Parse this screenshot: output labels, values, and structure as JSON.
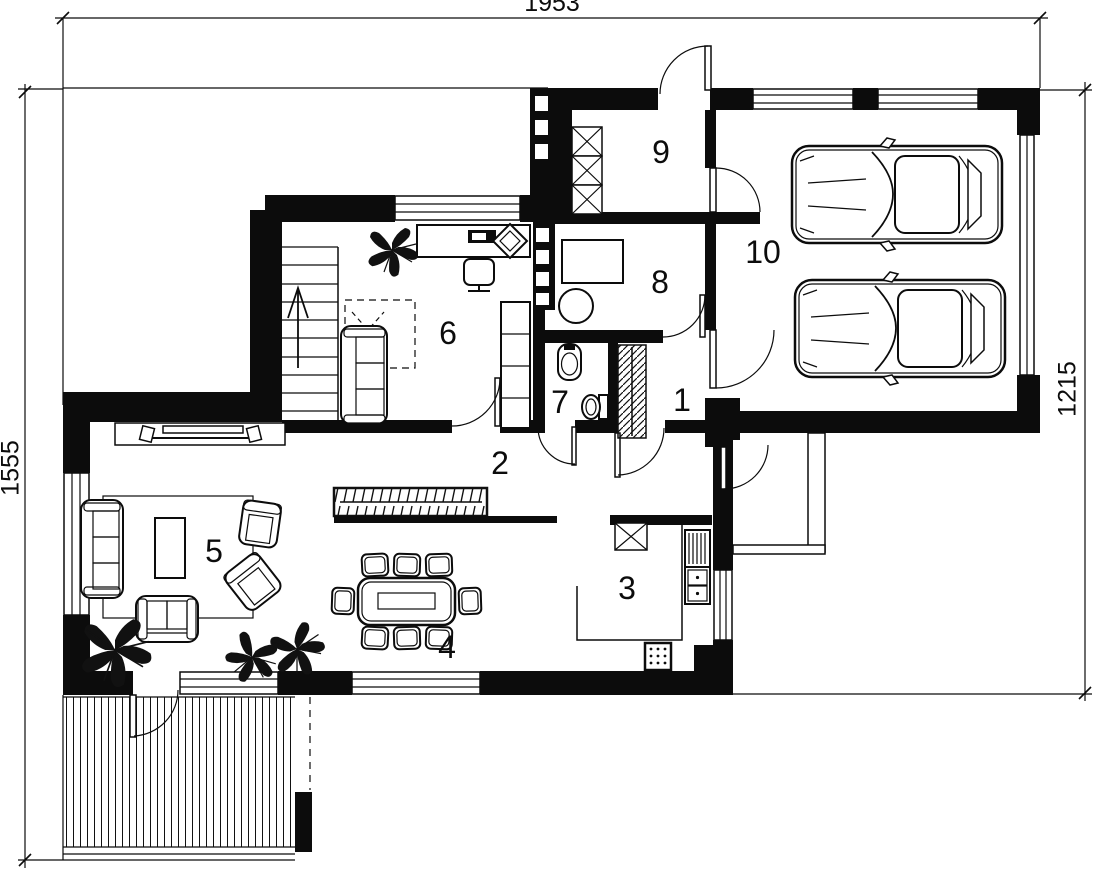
{
  "title": "House ground floor plan",
  "colors": {
    "ink": "#0c0c0c",
    "paper": "#ffffff"
  },
  "dimensions": {
    "top": "1953",
    "left": "1555",
    "right": "1215"
  },
  "rooms": [
    {
      "number": "1"
    },
    {
      "number": "2"
    },
    {
      "number": "3"
    },
    {
      "number": "4"
    },
    {
      "number": "5"
    },
    {
      "number": "6"
    },
    {
      "number": "7"
    },
    {
      "number": "8"
    },
    {
      "number": "9"
    },
    {
      "number": "10"
    }
  ]
}
